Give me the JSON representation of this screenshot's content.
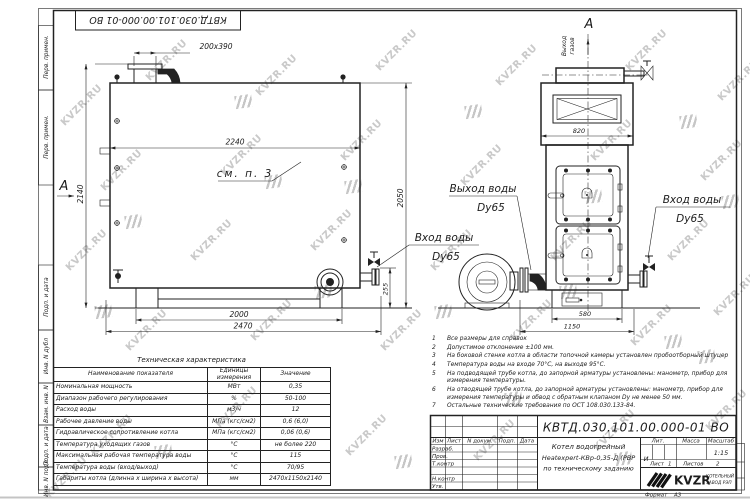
{
  "watermark": {
    "text": "KVZR.RU"
  },
  "stamp_top": "КВТД.030.101.00.000-01 ВО",
  "margin_labels": [
    "Перв. примен.",
    "Перв. примен.",
    "Подп. и дата",
    "Инв. N дубл",
    "Взам. инв. N",
    "Подп. и дата",
    "Инв. N подл"
  ],
  "drawing": {
    "section_marker": "А",
    "gas_outlet": {
      "line1": "Выход",
      "line2": "газов"
    },
    "see_note": "см. п. 3",
    "callouts": {
      "water_out": {
        "line1": "Выход воды",
        "line2": "Dy65"
      },
      "water_in_left": {
        "line1": "Вход воды",
        "line2": "Dy65"
      },
      "water_in_right": {
        "line1": "Вход воды",
        "line2": "Dy65"
      }
    },
    "dims": {
      "duct": "200x390",
      "length_inner": "2240",
      "height_left": "2140",
      "height_right": "2050",
      "inlet_height": "255",
      "base_length": "2000",
      "full_length": "2470",
      "front_width": "820",
      "base_width": "580",
      "full_width": "1150"
    }
  },
  "notes": {
    "items": [
      {
        "num": "1",
        "text": "Все размеры для справок"
      },
      {
        "num": "2",
        "text": "Допустимое отклонение ±100 мм."
      },
      {
        "num": "3",
        "text": "На боковой стенке котла в области топочной камеры установлен пробоотборный штуцер"
      },
      {
        "num": "4",
        "text": "Температура воды на входе 70°С, на выходе 95°С."
      },
      {
        "num": "5",
        "text": "На подводящей трубе котла, до запорной арматуры установлены: манометр, прибор для измерения температуры."
      },
      {
        "num": "6",
        "text": "На отводящей трубе котла, до запорной арматуры установлены: манометр, прибор для измерения температуры и обвод с обратным клапаном Dу не менее 50 мм."
      },
      {
        "num": "7",
        "text": "Остальные технические требования по ОСТ 108.030.133-84."
      }
    ]
  },
  "table": {
    "title": "Техническая характеристика",
    "headers": [
      "Наименование показателя",
      "Единицы измерения",
      "Значение"
    ],
    "rows": [
      [
        "Номинальная мощность",
        "МВт",
        "0,35"
      ],
      [
        "Диапазон рабочего регулирования",
        "%",
        "50-100"
      ],
      [
        "Расход воды",
        "м3/ч",
        "12"
      ],
      [
        "Рабочее давление воды",
        "МПа (кгс/см2)",
        "0,6 (6,0)"
      ],
      [
        "Гидравлическое сопротивление котла",
        "МПа (кгс/см2)",
        "0,06 (0,6)"
      ],
      [
        "Температура уходящих газов",
        "°С",
        "не более 220"
      ],
      [
        "Максимальная рабочая температура воды",
        "°С",
        "115"
      ],
      [
        "Температура воды (вход/выход)",
        "°С",
        "70/95"
      ],
      [
        "Габариты котла (длинна х ширина х высота)",
        "мм",
        "2470х1150х2140"
      ]
    ]
  },
  "titleblock": {
    "doc_number": "КВТД.030.101.00.000-01 ВО",
    "sig_headers": {
      "izm": "Изм",
      "list": "Лист",
      "doc": "N докум.",
      "podp": "Подп.",
      "data": "Дата"
    },
    "sig_rows": [
      "Разраб.",
      "Пров.",
      "Т.контр",
      "",
      "Н.контр",
      "Утв."
    ],
    "title_line1": "Котел водогрейный",
    "title_line2": "Heatexpert-КВр-0,35-Д (РВР",
    "title_line3": "по техническому заданию",
    "lit_header": "Лит.",
    "lit_value": "И",
    "mass_header": "Масса",
    "scale_header": "Масштаб",
    "scale_value": "1:15",
    "sheet_label": "Лист",
    "sheet_value": "1",
    "sheets_label": "Листов",
    "sheets_value": "2",
    "company_name": "KVZR",
    "company_sub1": "КОТЕЛЬНЫЙ",
    "company_sub2": "ЗАВОД РЭП",
    "format_label": "Формат",
    "format_value": "А3"
  }
}
